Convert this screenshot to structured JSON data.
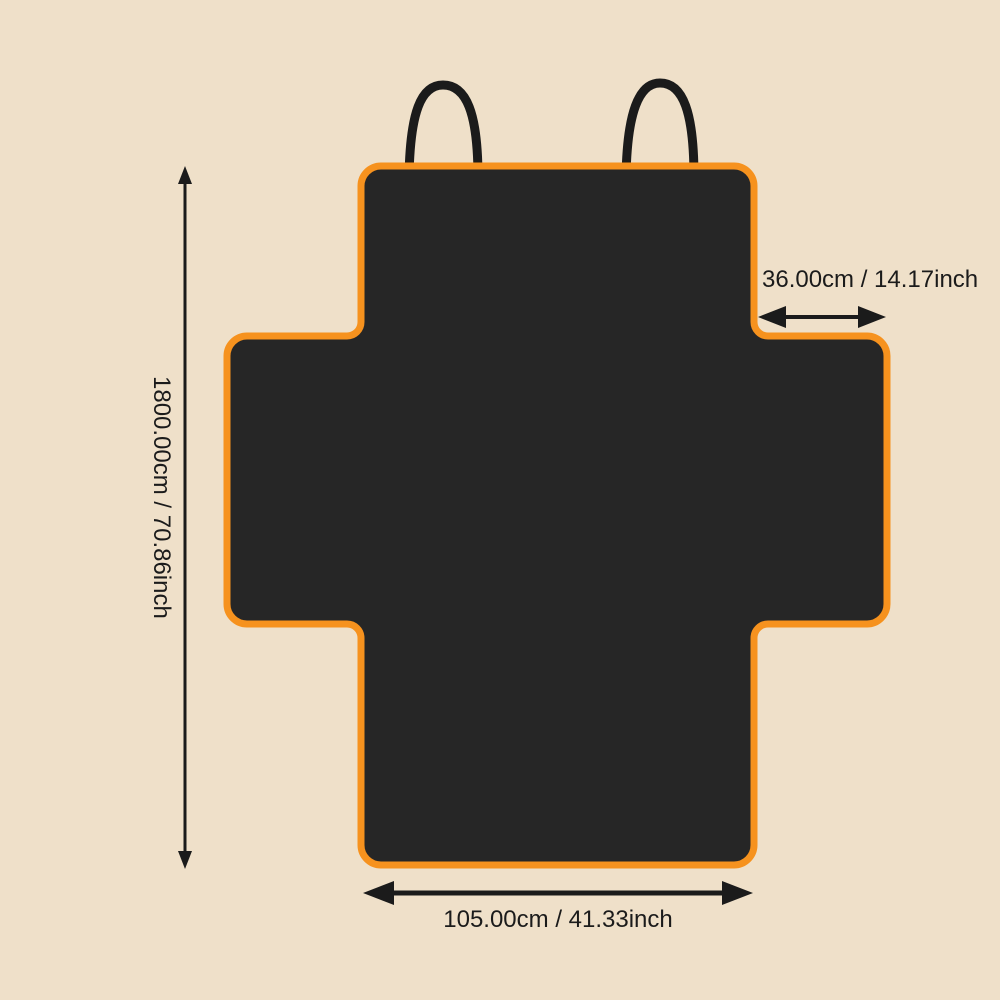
{
  "diagram": {
    "description": "Pet car seat cover dimension diagram, cross-shaped cover with headrest straps",
    "dimensions": {
      "height": {
        "label": "1800.00cm / 70.86inch",
        "cm": "1800.00",
        "inch": "70.86"
      },
      "bottom_width": {
        "label": "105.00cm / 41.33inch",
        "cm": "105.00",
        "inch": "41.33"
      },
      "side_flap_width": {
        "label": "36.00cm / 14.17inch",
        "cm": "36.00",
        "inch": "14.17"
      }
    }
  },
  "colors": {
    "background": "#EFE0C9",
    "cover_fill": "#262626",
    "trim_orange": "#F6921E",
    "ink_black": "#1B1B1B",
    "strap_black": "#1B1B1B"
  }
}
